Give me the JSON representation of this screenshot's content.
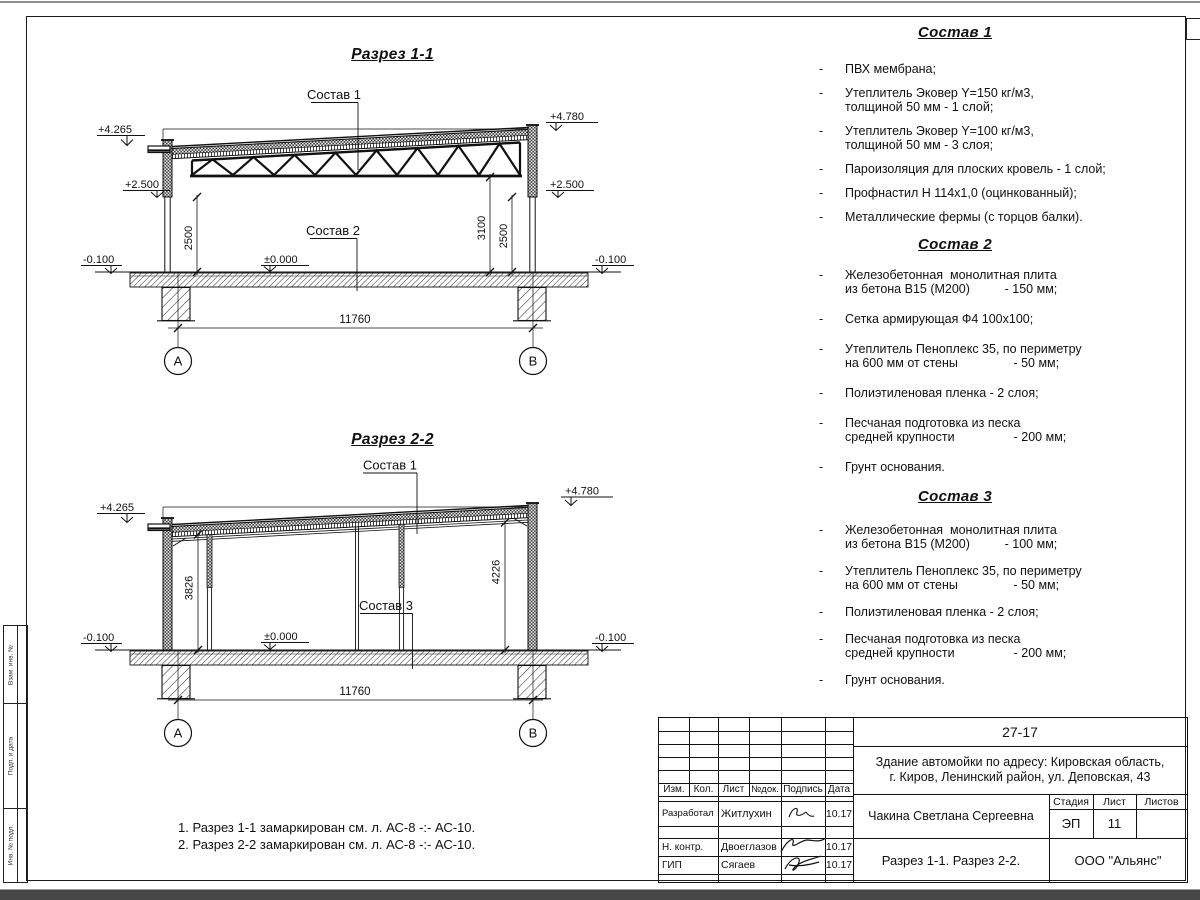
{
  "glyphs": {
    "dash": "-"
  },
  "side_stamp": {
    "labels": [
      "Взам. инв. №",
      "Подп. и дата",
      "Инв. № подл."
    ]
  },
  "section1": {
    "title": "Разрез 1-1",
    "sostav1_label": "Состав 1",
    "sostav2_label": "Состав 2",
    "elev_left_top": "+4.265",
    "elev_right_top": "+4.780",
    "elev_left_mid": "+2.500",
    "elev_right_mid": "+2.500",
    "elev_left_ground": "-0.100",
    "elev_right_ground": "-0.100",
    "elev_zero": "±0.000",
    "dim_left": "2500",
    "dim_right_inner": "3100",
    "dim_right_outer": "2500",
    "dim_span": "11760",
    "axis_a": "А",
    "axis_b": "В"
  },
  "section2": {
    "title": "Разрез 2-2",
    "sostav1_label": "Состав 1",
    "sostav3_label": "Состав 3",
    "elev_left_top": "+4.265",
    "elev_right_top": "+4.780",
    "elev_left_ground": "-0.100",
    "elev_right_ground": "-0.100",
    "elev_zero": "±0.000",
    "dim_left": "3826",
    "dim_right": "4226",
    "dim_span": "11760",
    "axis_a": "А",
    "axis_b": "В"
  },
  "compositions": [
    {
      "title": "Состав 1",
      "items": [
        [
          "ПВХ мембрана;"
        ],
        [
          "Утеплитель Эковер Y=150 кг/м3,",
          "толщиной 50 мм - 1 слой;"
        ],
        [
          "Утеплитель Эковер Y=100 кг/м3,",
          "толщиной 50 мм - 3 слоя;"
        ],
        [
          "Пароизоляция для плоских кровель - 1 слой;"
        ],
        [
          "Профнастил Н 114х1,0 (оцинкованный);"
        ],
        [
          "Металлические фермы (с торцов балки)."
        ]
      ]
    },
    {
      "title": "Состав 2",
      "items": [
        [
          "Железобетонная  монолитная плита",
          "из бетона В15 (М200)          - 150 мм;"
        ],
        [
          "Сетка армирующая Ф4 100х100;"
        ],
        [
          "Утеплитель Пеноплекс 35, по периметру",
          "на 600 мм от стены                - 50 мм;"
        ],
        [
          "Полиэтиленовая пленка - 2 слоя;"
        ],
        [
          "Песчаная подготовка из песка",
          "средней крупности                 - 200 мм;"
        ],
        [
          "Грунт основания."
        ]
      ]
    },
    {
      "title": "Состав 3",
      "items": [
        [
          "Железобетонная  монолитная плита",
          "из бетона В15 (М200)          - 100 мм;"
        ],
        [
          "Утеплитель Пеноплекс 35, по периметру",
          "на 600 мм от стены                - 50 мм;"
        ],
        [
          "Полиэтиленовая пленка - 2 слоя;"
        ],
        [
          "Песчаная подготовка из песка",
          "средней крупности                 - 200 мм;"
        ],
        [
          "Грунт основания."
        ]
      ]
    }
  ],
  "notes": [
    "1. Разрез 1-1 замаркирован см. л. АС-8 -:- АС-10.",
    "2. Разрез 2-2 замаркирован см. л. АС-8 -:- АС-10."
  ],
  "titleblock": {
    "doc_number": "27-17",
    "object_line1": "Здание автомойки по адресу: Кировская область,",
    "object_line2": "г. Киров, Ленинский район, ул. Деповская, 43",
    "cols": [
      "Изм.",
      "Кол.",
      "Лист",
      "№док.",
      "Подпись",
      "Дата"
    ],
    "rows": [
      {
        "role": "Разработал",
        "name": "Житлухин",
        "date": "10.17"
      },
      {
        "role": "Н. контр.",
        "name": "Двоеглазов",
        "date": "10.17"
      },
      {
        "role": "ГИП",
        "name": "Сягаев",
        "date": "10.17"
      }
    ],
    "author": "Чакина Светлана Сергеевна",
    "stage_label": "Стадия",
    "sheet_label": "Лист",
    "sheets_label": "Листов",
    "stage": "ЭП",
    "sheet": "11",
    "sheets": "",
    "sheet_title": "Разрез 1-1. Разрез 2-2.",
    "company": "ООО \"Альянс\""
  }
}
